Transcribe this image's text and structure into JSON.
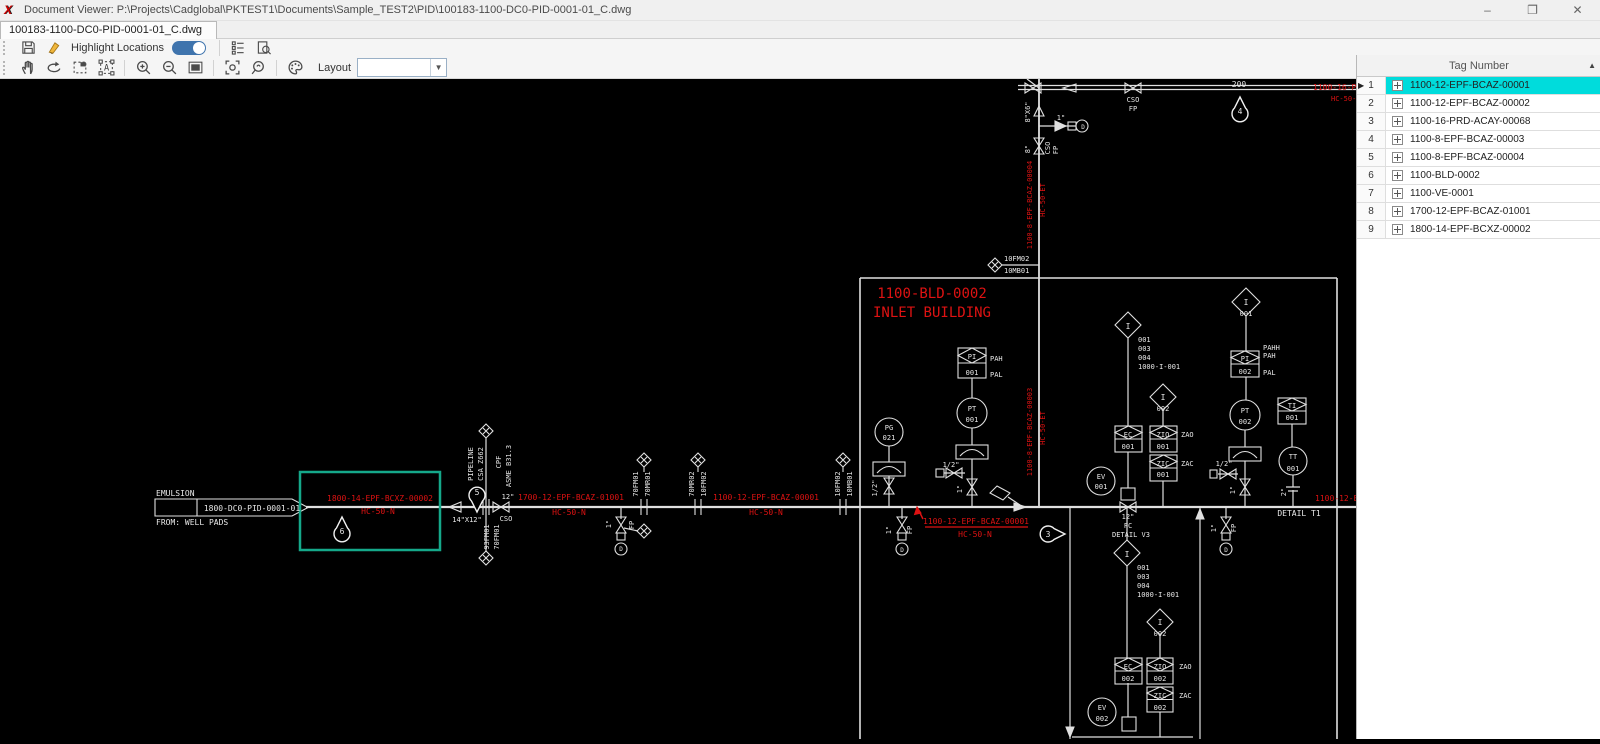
{
  "colors": {
    "selection_cyan": "#00dcdc",
    "toggle_blue": "#3f74ad",
    "highlight_teal": "#15a88a",
    "cad_red": "#de1212",
    "cad_white": "#e8e8e8"
  },
  "window": {
    "app_icon": "X",
    "title": "Document Viewer: P:\\Projects\\Cadglobal\\PKTEST1\\Documents\\Sample_TEST2\\PID\\100183-1100-DC0-PID-0001-01_C.dwg",
    "controls": {
      "minimize": "–",
      "restore": "❐",
      "close": "✕"
    }
  },
  "tab": {
    "label": "100183-1100-DC0-PID-0001-01_C.dwg"
  },
  "toolbar": {
    "highlight_label": "Highlight Locations",
    "toggle_on": true,
    "layout_label": "Layout",
    "layout_value": ""
  },
  "tag_panel": {
    "header": "Tag Number",
    "sort_arrow": "▲",
    "rows": [
      {
        "num": "1",
        "tag": "1100-12-EPF-BCAZ-00001",
        "selected": true
      },
      {
        "num": "2",
        "tag": "1100-12-EPF-BCAZ-00002",
        "selected": false
      },
      {
        "num": "3",
        "tag": "1100-16-PRD-ACAY-00068",
        "selected": false
      },
      {
        "num": "4",
        "tag": "1100-8-EPF-BCAZ-00003",
        "selected": false
      },
      {
        "num": "5",
        "tag": "1100-8-EPF-BCAZ-00004",
        "selected": false
      },
      {
        "num": "6",
        "tag": "1100-BLD-0002",
        "selected": false
      },
      {
        "num": "7",
        "tag": "1100-VE-0001",
        "selected": false
      },
      {
        "num": "8",
        "tag": "1700-12-EPF-BCAZ-01001",
        "selected": false
      },
      {
        "num": "9",
        "tag": "1800-14-EPF-BCXZ-00002",
        "selected": false
      }
    ]
  },
  "drawing": {
    "labels": [
      {
        "t": "EMULSION",
        "x": 156,
        "y": 496,
        "a": "s"
      },
      {
        "t": "1800-DC0-PID-0001-01",
        "x": 252,
        "y": 511
      },
      {
        "t": "FROM: WELL PADS",
        "x": 156,
        "y": 525,
        "a": "s"
      },
      {
        "t": "1800-14-EPF-BCXZ-00002",
        "x": 380,
        "y": 501,
        "c": "r"
      },
      {
        "t": "HC-50-N",
        "x": 378,
        "y": 514,
        "c": "r"
      },
      {
        "t": "6",
        "x": 342,
        "y": 534
      },
      {
        "t": "5",
        "x": 477,
        "y": 495
      },
      {
        "t": "PIPELINE",
        "x": 473,
        "y": 464,
        "r": 1,
        "s": 7
      },
      {
        "t": "CSA Z662",
        "x": 483,
        "y": 464,
        "r": 1,
        "s": 7
      },
      {
        "t": "CPF",
        "x": 501,
        "y": 462,
        "r": 1,
        "s": 7
      },
      {
        "t": "ASME B31.3",
        "x": 511,
        "y": 466,
        "r": 1,
        "s": 7
      },
      {
        "t": "14\"X12\"",
        "x": 467,
        "y": 522,
        "s": 7
      },
      {
        "t": "12\"",
        "x": 508,
        "y": 499,
        "s": 7
      },
      {
        "t": "CSO",
        "x": 506,
        "y": 521,
        "s": 7
      },
      {
        "t": "93FM01",
        "x": 489,
        "y": 537,
        "r": 1,
        "s": 7
      },
      {
        "t": "70FM01",
        "x": 499,
        "y": 537,
        "r": 1,
        "s": 7
      },
      {
        "t": "1700-12-EPF-BCAZ-01001",
        "x": 571,
        "y": 500,
        "c": "r"
      },
      {
        "t": "HC-50-N",
        "x": 569,
        "y": 515,
        "c": "r"
      },
      {
        "t": "1\"",
        "x": 611,
        "y": 524,
        "r": 1,
        "s": 7
      },
      {
        "t": "FP",
        "x": 634,
        "y": 525,
        "r": 1,
        "s": 7
      },
      {
        "t": "D",
        "x": 621,
        "y": 551,
        "s": 6
      },
      {
        "t": "70FM01",
        "x": 638,
        "y": 484,
        "r": 1,
        "s": 7
      },
      {
        "t": "70MR01",
        "x": 650,
        "y": 484,
        "r": 1,
        "s": 7
      },
      {
        "t": "70MR02",
        "x": 694,
        "y": 484,
        "r": 1,
        "s": 7
      },
      {
        "t": "10FM02",
        "x": 706,
        "y": 484,
        "r": 1,
        "s": 7
      },
      {
        "t": "1100-12-EPF-BCAZ-00001",
        "x": 766,
        "y": 500,
        "c": "r"
      },
      {
        "t": "HC-50-N",
        "x": 766,
        "y": 515,
        "c": "r"
      },
      {
        "t": "10FM02",
        "x": 840,
        "y": 484,
        "r": 1,
        "s": 7
      },
      {
        "t": "10MB01",
        "x": 852,
        "y": 484,
        "r": 1,
        "s": 7
      },
      {
        "t": "1100-BLD-0002",
        "x": 932,
        "y": 298,
        "c": "r",
        "s": 14
      },
      {
        "t": "INLET BUILDING",
        "x": 932,
        "y": 317,
        "c": "r",
        "s": 14
      },
      {
        "t": "10FM02",
        "x": 1004,
        "y": 261,
        "a": "s",
        "s": 7
      },
      {
        "t": "10MB01",
        "x": 1004,
        "y": 273,
        "a": "s",
        "s": 7
      },
      {
        "t": "8\"X6\"",
        "x": 1030,
        "y": 112,
        "r": 1,
        "s": 7
      },
      {
        "t": "1\"",
        "x": 1061,
        "y": 120,
        "s": 7
      },
      {
        "t": "D",
        "x": 1083,
        "y": 129,
        "s": 6
      },
      {
        "t": "8\"",
        "x": 1030,
        "y": 149,
        "r": 1,
        "s": 7
      },
      {
        "t": "CSO",
        "x": 1050,
        "y": 148,
        "r": 1,
        "s": 7
      },
      {
        "t": "FP",
        "x": 1058,
        "y": 150,
        "r": 1,
        "s": 7
      },
      {
        "t": "CSO",
        "x": 1133,
        "y": 102,
        "s": 7
      },
      {
        "t": "FP",
        "x": 1133,
        "y": 111,
        "s": 7
      },
      {
        "t": "200",
        "x": 1239,
        "y": 87
      },
      {
        "t": "4",
        "x": 1240,
        "y": 114
      },
      {
        "t": "1100-16-PRD-ACAY-00068",
        "x": 1313,
        "y": 90,
        "c": "r",
        "a": "s"
      },
      {
        "t": "HC-50-ET",
        "x": 1331,
        "y": 101,
        "c": "r",
        "a": "s",
        "s": 7
      },
      {
        "t": "1100-8-EPF-BCAZ-00004",
        "x": 1032,
        "y": 205,
        "c": "r",
        "r": 1,
        "s": 7
      },
      {
        "t": "HC-50-ET",
        "x": 1045,
        "y": 200,
        "c": "r",
        "r": 1,
        "s": 7
      },
      {
        "t": "1100-8-EPF-BCAZ-00003",
        "x": 1032,
        "y": 432,
        "c": "r",
        "r": 1,
        "s": 7
      },
      {
        "t": "HC-50-ET",
        "x": 1045,
        "y": 428,
        "c": "r",
        "r": 1,
        "s": 7
      },
      {
        "t": "PG",
        "x": 889,
        "y": 430,
        "s": 7
      },
      {
        "t": "021",
        "x": 889,
        "y": 440,
        "s": 7
      },
      {
        "t": "1/2\"",
        "x": 877,
        "y": 488,
        "r": 1,
        "s": 7
      },
      {
        "t": "PI",
        "x": 972,
        "y": 359,
        "s": 7
      },
      {
        "t": "001",
        "x": 972,
        "y": 375,
        "s": 7
      },
      {
        "t": "PAH",
        "x": 990,
        "y": 361,
        "a": "s",
        "s": 7
      },
      {
        "t": "PAL",
        "x": 990,
        "y": 377,
        "a": "s",
        "s": 7
      },
      {
        "t": "PT",
        "x": 972,
        "y": 411,
        "s": 7
      },
      {
        "t": "001",
        "x": 972,
        "y": 422,
        "s": 7
      },
      {
        "t": "1/2\"",
        "x": 951,
        "y": 467,
        "s": 7
      },
      {
        "t": "1\"",
        "x": 962,
        "y": 489,
        "r": 1,
        "s": 7
      },
      {
        "t": "1\"",
        "x": 891,
        "y": 530,
        "r": 1,
        "s": 7
      },
      {
        "t": "FP",
        "x": 912,
        "y": 530,
        "r": 1,
        "s": 7
      },
      {
        "t": "D",
        "x": 902,
        "y": 552,
        "s": 6
      },
      {
        "t": "1100-12-EPF-BCAZ-00001",
        "x": 976,
        "y": 524,
        "c": "r"
      },
      {
        "t": "HC-50-N",
        "x": 975,
        "y": 537,
        "c": "r"
      },
      {
        "t": "3",
        "x": 1048,
        "y": 537
      },
      {
        "t": "EV",
        "x": 1101,
        "y": 479,
        "s": 7
      },
      {
        "t": "001",
        "x": 1101,
        "y": 489,
        "s": 7
      },
      {
        "t": "12\"",
        "x": 1128,
        "y": 519,
        "s": 7
      },
      {
        "t": "FC",
        "x": 1128,
        "y": 528,
        "s": 7
      },
      {
        "t": "DETAIL V3",
        "x": 1131,
        "y": 537,
        "s": 7
      },
      {
        "t": "I",
        "x": 1128,
        "y": 329
      },
      {
        "t": "001",
        "x": 1138,
        "y": 342,
        "a": "s",
        "s": 7
      },
      {
        "t": "003",
        "x": 1138,
        "y": 351,
        "a": "s",
        "s": 7
      },
      {
        "t": "004",
        "x": 1138,
        "y": 360,
        "a": "s",
        "s": 7
      },
      {
        "t": "1000-I-001",
        "x": 1138,
        "y": 369,
        "a": "s",
        "s": 7
      },
      {
        "t": "I",
        "x": 1163,
        "y": 400
      },
      {
        "t": "002",
        "x": 1163,
        "y": 411,
        "s": 7
      },
      {
        "t": "EC",
        "x": 1128,
        "y": 437,
        "s": 7
      },
      {
        "t": "001",
        "x": 1128,
        "y": 449,
        "s": 7
      },
      {
        "t": "ZIO",
        "x": 1163,
        "y": 437,
        "s": 7
      },
      {
        "t": "001",
        "x": 1163,
        "y": 449,
        "s": 7
      },
      {
        "t": "ZAO",
        "x": 1181,
        "y": 437,
        "a": "s",
        "s": 7
      },
      {
        "t": "ZIC",
        "x": 1163,
        "y": 466,
        "s": 7
      },
      {
        "t": "001",
        "x": 1163,
        "y": 477,
        "s": 7
      },
      {
        "t": "ZAC",
        "x": 1181,
        "y": 466,
        "a": "s",
        "s": 7
      },
      {
        "t": "I",
        "x": 1127,
        "y": 557
      },
      {
        "t": "001",
        "x": 1137,
        "y": 570,
        "a": "s",
        "s": 7
      },
      {
        "t": "003",
        "x": 1137,
        "y": 579,
        "a": "s",
        "s": 7
      },
      {
        "t": "004",
        "x": 1137,
        "y": 588,
        "a": "s",
        "s": 7
      },
      {
        "t": "1000-I-001",
        "x": 1137,
        "y": 597,
        "a": "s",
        "s": 7
      },
      {
        "t": "I",
        "x": 1160,
        "y": 625
      },
      {
        "t": "002",
        "x": 1160,
        "y": 636,
        "s": 7
      },
      {
        "t": "EC",
        "x": 1128,
        "y": 669,
        "s": 7
      },
      {
        "t": "002",
        "x": 1128,
        "y": 681,
        "s": 7
      },
      {
        "t": "ZIO",
        "x": 1160,
        "y": 669,
        "s": 7
      },
      {
        "t": "002",
        "x": 1160,
        "y": 681,
        "s": 7
      },
      {
        "t": "ZAO",
        "x": 1179,
        "y": 669,
        "a": "s",
        "s": 7
      },
      {
        "t": "ZIC",
        "x": 1160,
        "y": 698,
        "s": 7
      },
      {
        "t": "002",
        "x": 1160,
        "y": 710,
        "s": 7
      },
      {
        "t": "ZAC",
        "x": 1179,
        "y": 698,
        "a": "s",
        "s": 7
      },
      {
        "t": "EV",
        "x": 1102,
        "y": 710,
        "s": 7
      },
      {
        "t": "002",
        "x": 1102,
        "y": 721,
        "s": 7
      },
      {
        "t": "I",
        "x": 1246,
        "y": 305
      },
      {
        "t": "001",
        "x": 1246,
        "y": 316,
        "s": 7
      },
      {
        "t": "PAHH",
        "x": 1263,
        "y": 350,
        "a": "s",
        "s": 7
      },
      {
        "t": "PAH",
        "x": 1263,
        "y": 358,
        "a": "s",
        "s": 7
      },
      {
        "t": "PI",
        "x": 1245,
        "y": 361,
        "s": 7
      },
      {
        "t": "002",
        "x": 1245,
        "y": 374,
        "s": 7
      },
      {
        "t": "PAL",
        "x": 1263,
        "y": 375,
        "a": "s",
        "s": 7
      },
      {
        "t": "PT",
        "x": 1245,
        "y": 413,
        "s": 7
      },
      {
        "t": "002",
        "x": 1245,
        "y": 424,
        "s": 7
      },
      {
        "t": "1/2\"",
        "x": 1224,
        "y": 466,
        "s": 7
      },
      {
        "t": "1\"",
        "x": 1235,
        "y": 490,
        "r": 1,
        "s": 7
      },
      {
        "t": "TI",
        "x": 1292,
        "y": 408,
        "s": 7
      },
      {
        "t": "001",
        "x": 1292,
        "y": 420,
        "s": 7
      },
      {
        "t": "TT",
        "x": 1293,
        "y": 459,
        "s": 7
      },
      {
        "t": "001",
        "x": 1293,
        "y": 471,
        "s": 7
      },
      {
        "t": "2\"",
        "x": 1286,
        "y": 492,
        "r": 1,
        "s": 7
      },
      {
        "t": "DETAIL T1",
        "x": 1299,
        "y": 516
      },
      {
        "t": "1100-12-EPF-BCAZ-00002",
        "x": 1315,
        "y": 501,
        "c": "r",
        "a": "s"
      },
      {
        "t": "1\"",
        "x": 1216,
        "y": 528,
        "r": 1,
        "s": 7
      },
      {
        "t": "FP",
        "x": 1236,
        "y": 528,
        "r": 1,
        "s": 7
      },
      {
        "t": "D",
        "x": 1226,
        "y": 552,
        "s": 6
      }
    ]
  }
}
